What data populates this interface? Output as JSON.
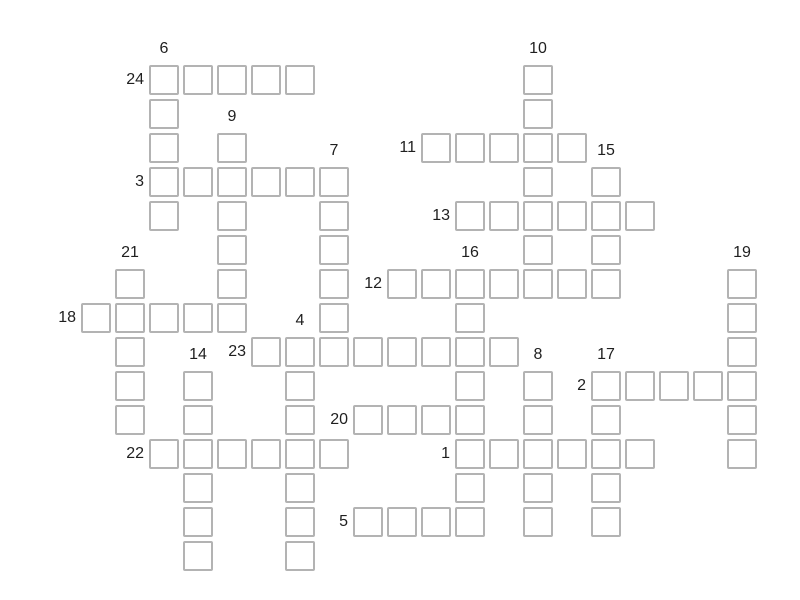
{
  "app": {
    "type": "crossword-puzzle-grid"
  },
  "puzzle": {
    "colors": {
      "background": "#ffffff",
      "cell_fill": "#ffffff",
      "cell_border": "#b3b3b3",
      "number_text": "#1f1f1f"
    },
    "grid": {
      "origin_x": 81,
      "origin_y": 65,
      "pitch": 34,
      "cell_size": 30,
      "columns": 20,
      "rows": 15
    },
    "words": [
      {
        "number": 1,
        "direction": "across",
        "row": 11,
        "col": 11,
        "length": 6
      },
      {
        "number": 2,
        "direction": "across",
        "row": 9,
        "col": 15,
        "length": 5
      },
      {
        "number": 3,
        "direction": "across",
        "row": 3,
        "col": 2,
        "length": 6
      },
      {
        "number": 4,
        "direction": "down",
        "row": 8,
        "col": 6,
        "length": 7
      },
      {
        "number": 5,
        "direction": "across",
        "row": 13,
        "col": 8,
        "length": 4
      },
      {
        "number": 6,
        "direction": "down",
        "row": 0,
        "col": 2,
        "length": 5
      },
      {
        "number": 7,
        "direction": "down",
        "row": 3,
        "col": 7,
        "length": 6
      },
      {
        "number": 8,
        "direction": "down",
        "row": 9,
        "col": 13,
        "length": 5
      },
      {
        "number": 9,
        "direction": "down",
        "row": 2,
        "col": 4,
        "length": 6
      },
      {
        "number": 10,
        "direction": "down",
        "row": 0,
        "col": 13,
        "length": 7
      },
      {
        "number": 11,
        "direction": "across",
        "row": 2,
        "col": 10,
        "length": 5
      },
      {
        "number": 12,
        "direction": "across",
        "row": 6,
        "col": 9,
        "length": 7
      },
      {
        "number": 13,
        "direction": "across",
        "row": 4,
        "col": 11,
        "length": 6
      },
      {
        "number": 14,
        "direction": "down",
        "row": 9,
        "col": 3,
        "length": 6
      },
      {
        "number": 15,
        "direction": "down",
        "row": 3,
        "col": 15,
        "length": 4
      },
      {
        "number": 16,
        "direction": "down",
        "row": 6,
        "col": 11,
        "length": 8
      },
      {
        "number": 17,
        "direction": "down",
        "row": 9,
        "col": 15,
        "length": 5
      },
      {
        "number": 18,
        "direction": "across",
        "row": 7,
        "col": 0,
        "length": 5
      },
      {
        "number": 19,
        "direction": "down",
        "row": 6,
        "col": 19,
        "length": 6
      },
      {
        "number": 20,
        "direction": "across",
        "row": 10,
        "col": 8,
        "length": 4
      },
      {
        "number": 21,
        "direction": "down",
        "row": 6,
        "col": 1,
        "length": 5
      },
      {
        "number": 22,
        "direction": "across",
        "row": 11,
        "col": 2,
        "length": 6
      },
      {
        "number": 23,
        "direction": "across",
        "row": 8,
        "col": 5,
        "length": 8
      },
      {
        "number": 24,
        "direction": "across",
        "row": 0,
        "col": 2,
        "length": 5
      }
    ]
  }
}
